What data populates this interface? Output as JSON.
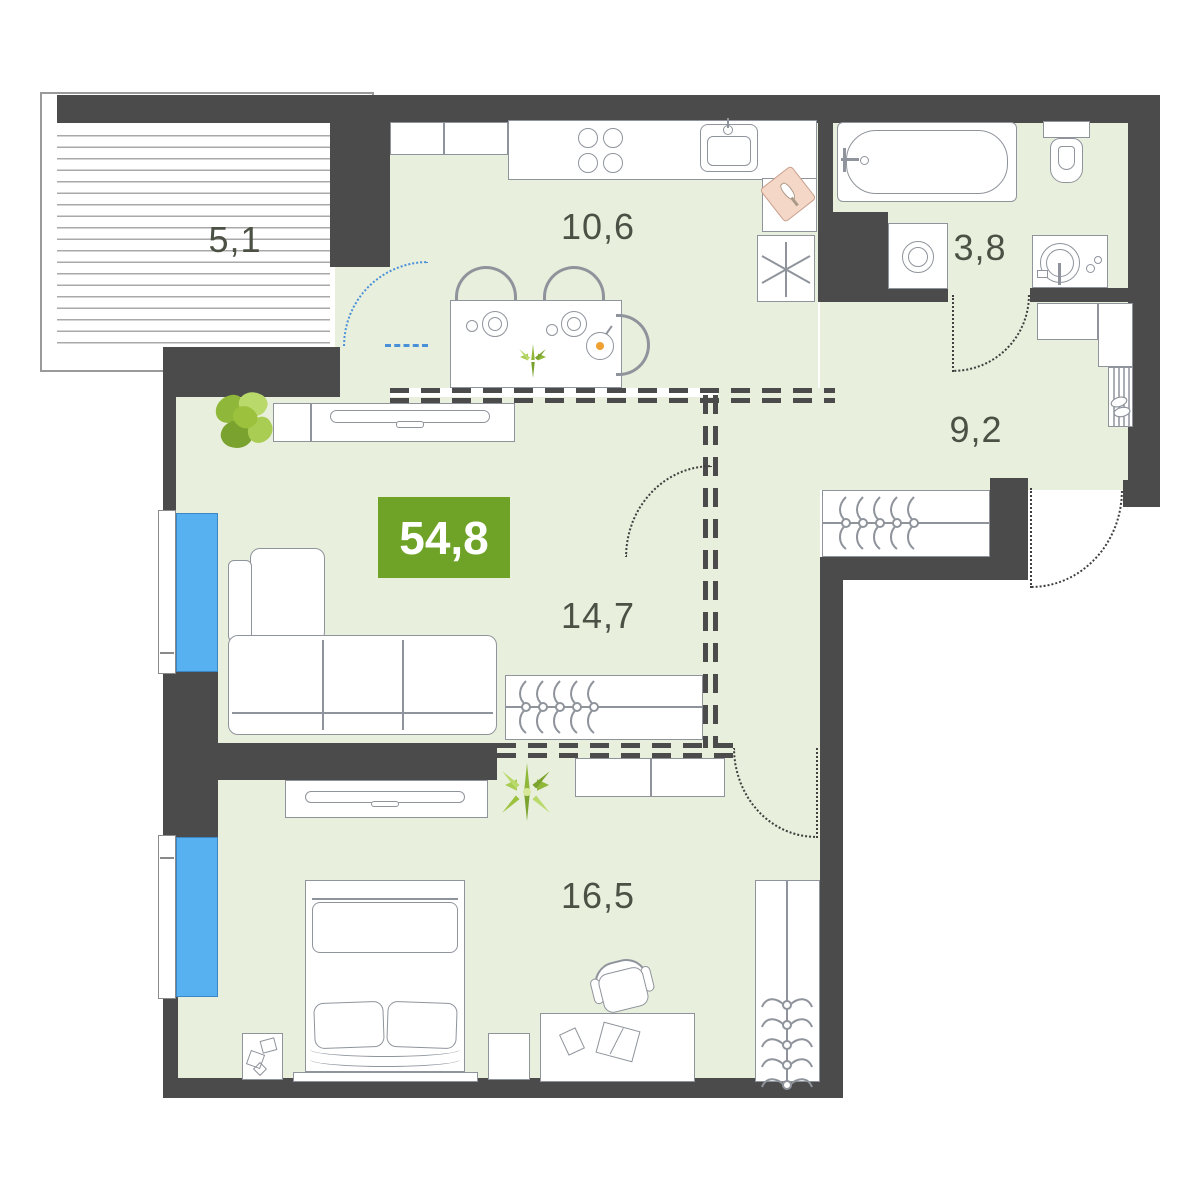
{
  "plan": {
    "title": "apartment-floor-plan",
    "total_area": "54,8",
    "rooms": [
      {
        "name": "balcony",
        "area": "5,1"
      },
      {
        "name": "kitchen",
        "area": "10,6"
      },
      {
        "name": "bathroom",
        "area": "3,8"
      },
      {
        "name": "hallway",
        "area": "9,2"
      },
      {
        "name": "living-room",
        "area": "14,7"
      },
      {
        "name": "bedroom",
        "area": "16,5"
      }
    ],
    "colors": {
      "wall": "#4b4b4b",
      "floor": "#e8efdc",
      "window": "#57b1f1",
      "badge": "#6fa328",
      "balcony_door": "#4a90d9"
    }
  }
}
